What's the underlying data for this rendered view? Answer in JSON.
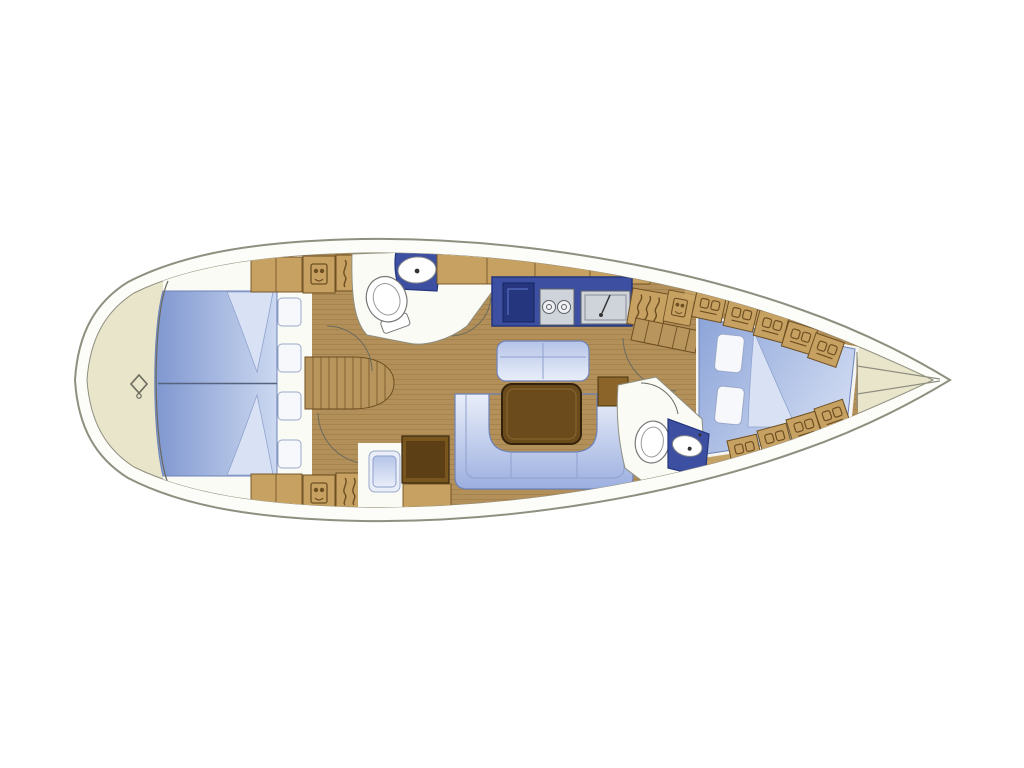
{
  "diagram": {
    "type": "sailing-yacht-interior-floor-plan",
    "orientation": "bow-left-stern-right",
    "visible_text": ""
  },
  "palette": {
    "page_bg": "#ffffff",
    "hull_line": "#8f8f80",
    "hull_white": "#fcfcf8",
    "deck": "#e9e5cb",
    "wood": "#b3905a",
    "wood_line": "#97763f",
    "cabinet": "#c6a161",
    "cabinet_light": "#cdab6b",
    "cabinet_line": "#6e4f22",
    "table": "#6b4a1c",
    "table_line": "#33230c",
    "table_inner": "#5c3f14",
    "counter_blue": "#3c4fa0",
    "counter_dark": "#25367e",
    "steel": "#cfd3da",
    "steel_line": "#5c6068",
    "uph_dark": "#7f97d0",
    "uph_mid": "#9cafe0",
    "uph_soft": "#b5c4e8",
    "uph_light": "#e9eef9",
    "sheet": "#d9e2f4",
    "sheet_line": "#8fa3cf",
    "pillow": "#f7f8fb",
    "pillow_line": "#9aa8c8",
    "white_floor": "#fbfbf6",
    "line": "#6a6a5e",
    "berth_split": "#55637e"
  },
  "regions": {
    "bow": "anchor locker with deck fitting",
    "forward_cabin": "V-berth double cabin with four pillows",
    "forward_head": "toilet and washbasin compartment",
    "saloon": "U-shaped sofa, bench settee and table",
    "galley": "icebox, two-burner stove and sink",
    "nav_station": "chart table with navigator seat",
    "companionway": "steps, hanging locker and stowage",
    "aft_cabin": "diagonal double berth with side lockers",
    "aft_head": "toilet and washbasin compartment",
    "stern": "tapered stern cone"
  }
}
